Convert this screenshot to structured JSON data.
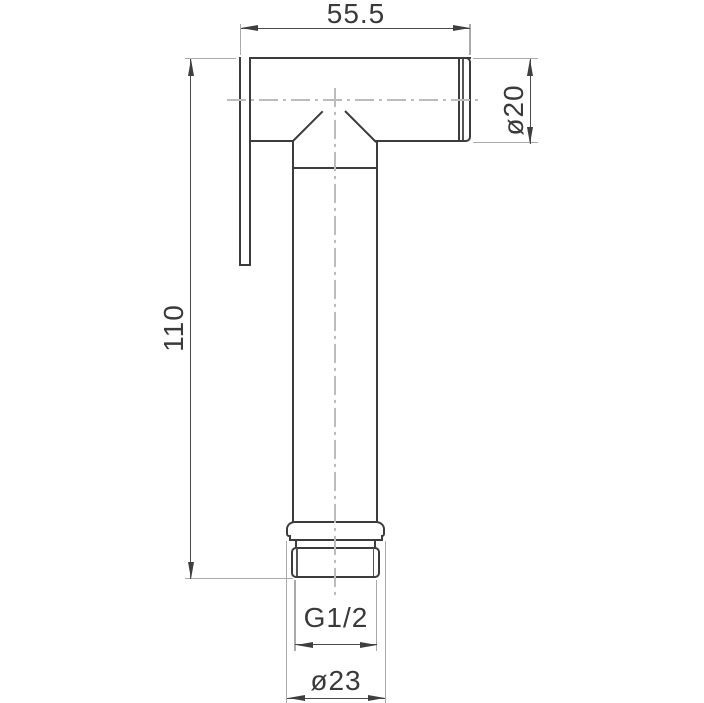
{
  "drawing": {
    "type": "technical-dimension-drawing",
    "subject": "handheld bidet sprayer handset, side elevation",
    "labels": {
      "width_top": "55.5",
      "height_left": "110",
      "diameter_head": "ø20",
      "thread": "G1/2",
      "diameter_bottom": "ø23"
    },
    "colors": {
      "background": "#ffffff",
      "outline": "#3c3c3c",
      "dimension_line": "#4a4a4a",
      "extension_line": "#aaaaaa",
      "centerline": "#bcbcbc",
      "text": "#3a3a3a"
    }
  }
}
